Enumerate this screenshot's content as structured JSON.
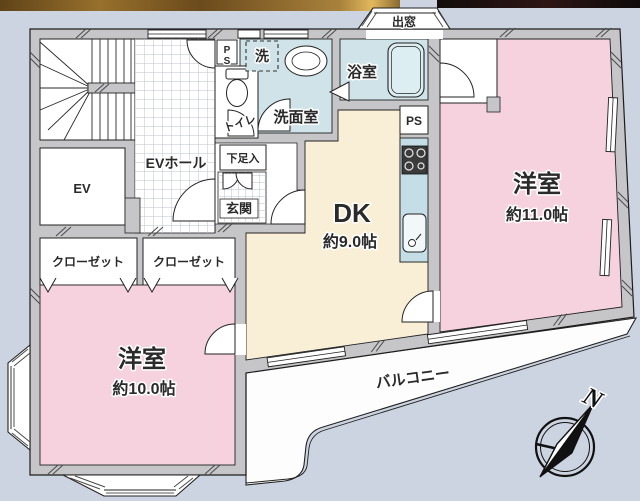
{
  "floorplan": {
    "rooms": {
      "western11": {
        "name": "洋室",
        "size": "約11.0帖"
      },
      "western10": {
        "name": "洋室",
        "size": "約10.0帖"
      },
      "dk": {
        "name": "DK",
        "size": "約9.0帖"
      },
      "closet_left": {
        "name": "クローゼット"
      },
      "closet_right": {
        "name": "クローゼット"
      },
      "ev": {
        "name": "EV"
      },
      "ev_hall": {
        "name": "EVホール"
      },
      "toilet": {
        "name": "トイレ"
      },
      "washroom": {
        "name": "洗面室"
      },
      "washer": {
        "name": "洗"
      },
      "bathroom": {
        "name": "浴室"
      },
      "entrance": {
        "name": "玄関"
      },
      "shoe_cabinet": {
        "name": "下足入"
      },
      "ps_upper": {
        "name": "PS"
      },
      "ps_kitchen": {
        "name": "PS"
      },
      "bay_window": {
        "name": "出窓"
      },
      "balcony": {
        "name": "バルコニー"
      }
    },
    "compass": {
      "north": "N"
    },
    "colors": {
      "background": "#cdd4e1",
      "wall": "#c6c6c8",
      "room_pink": "#f6d2de",
      "dk_cream": "#f9efd6",
      "wet_area_blue": "#cfe3e8",
      "wood_strip": "#8a6a30",
      "dark_strip": "#17110f"
    }
  }
}
